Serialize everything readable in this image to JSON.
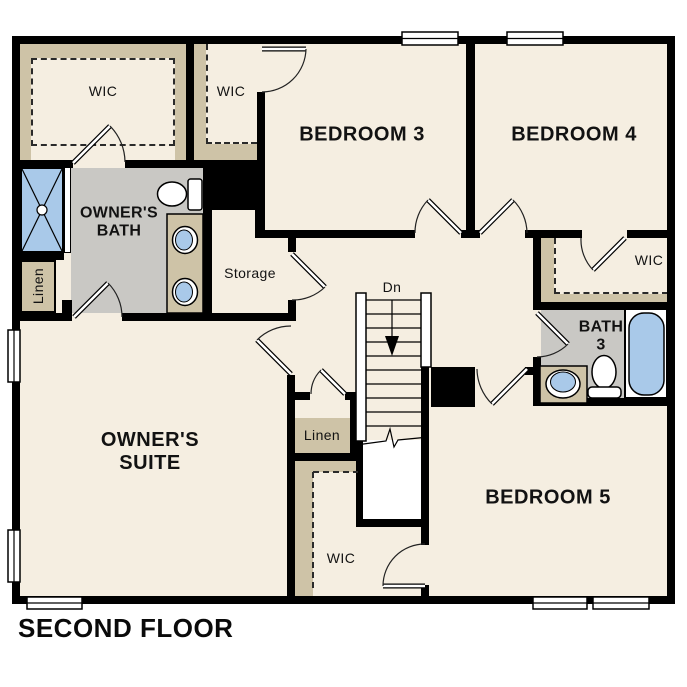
{
  "plan_title": "SECOND FLOOR",
  "labels": {
    "wic_owner": "WIC",
    "wic_bedroom3": "WIC",
    "bedroom3": "BEDROOM 3",
    "bedroom4": "BEDROOM 4",
    "owners_bath": [
      "OWNER'S",
      "BATH"
    ],
    "storage": "Storage",
    "linen_owner": "Linen",
    "stairs_down": "Dn",
    "wic_bedroom4": "WIC",
    "bath3": [
      "BATH",
      "3"
    ],
    "owners_suite": [
      "OWNER'S",
      "SUITE"
    ],
    "linen_hall": "Linen",
    "wic_bedroom5": "WIC",
    "bedroom5": "BEDROOM 5"
  },
  "colors": {
    "paper": "#ffffff",
    "wall": "#000000",
    "cream": "#f5eee1",
    "tan": "#cec3a7",
    "gray": "#c9c8c4",
    "blue": "#a9c9e9"
  }
}
